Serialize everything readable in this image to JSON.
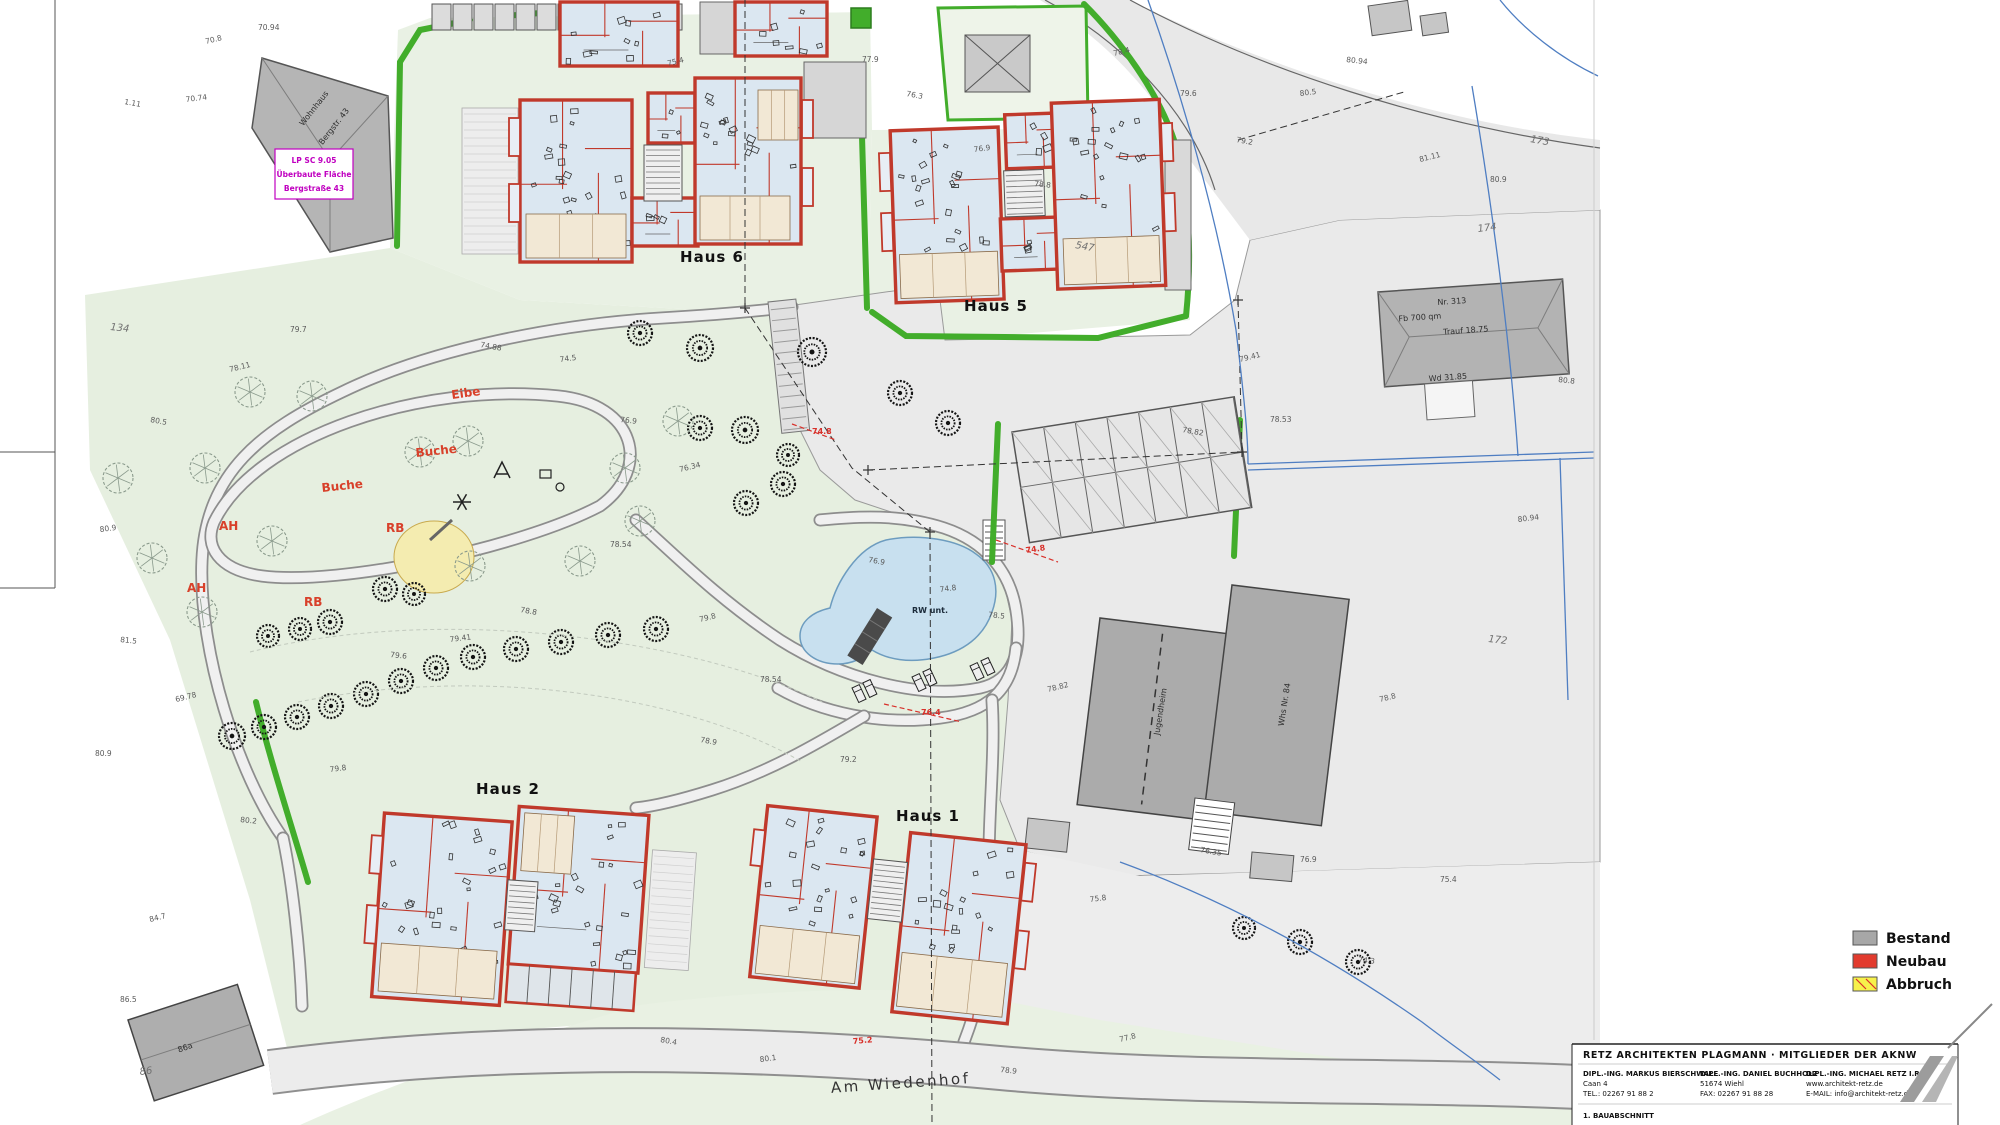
{
  "legend": {
    "items": [
      {
        "label": "Bestand",
        "color": "#a7a7a7"
      },
      {
        "label": "Neubau",
        "color": "#e23b2e"
      },
      {
        "label": "Abbruch",
        "color": "#f6f14b"
      }
    ]
  },
  "labels": {
    "houses": [
      {
        "text": "Haus 6",
        "x": 712,
        "y": 262
      },
      {
        "text": "Haus 5",
        "x": 996,
        "y": 311
      },
      {
        "text": "Haus 2",
        "x": 508,
        "y": 794
      },
      {
        "text": "Haus 1",
        "x": 928,
        "y": 821
      }
    ],
    "street": {
      "text": "Am Wiedenhof",
      "x": 901,
      "y": 1088,
      "rot": -4
    },
    "trees": [
      {
        "text": "Eibe",
        "x": 452,
        "y": 399,
        "rot": -8
      },
      {
        "text": "Buche",
        "x": 416,
        "y": 457,
        "rot": -6
      },
      {
        "text": "Buche",
        "x": 322,
        "y": 492,
        "rot": -6
      },
      {
        "text": "AH",
        "x": 219,
        "y": 530,
        "rot": 0
      },
      {
        "text": "RB",
        "x": 386,
        "y": 532,
        "rot": 0
      },
      {
        "text": "AH",
        "x": 187,
        "y": 592,
        "rot": 0
      },
      {
        "text": "RB",
        "x": 304,
        "y": 606,
        "rot": 0
      }
    ],
    "pond": {
      "text": "RW unt.",
      "x": 912,
      "y": 613
    },
    "bestand": [
      {
        "text": "Nr. 313",
        "x": 1452,
        "y": 304,
        "rot": -4
      },
      {
        "text": "Fb 700 qm",
        "x": 1420,
        "y": 320,
        "rot": -4
      },
      {
        "text": "Trauf 18.75",
        "x": 1466,
        "y": 333,
        "rot": -4
      },
      {
        "text": "Wd 31.85",
        "x": 1448,
        "y": 380,
        "rot": -4
      },
      {
        "text": "Jugendheim",
        "x": 1163,
        "y": 712,
        "rot": -81
      },
      {
        "text": "Whs Nr. 84",
        "x": 1287,
        "y": 705,
        "rot": -81
      },
      {
        "text": "86a",
        "x": 186,
        "y": 1050,
        "rot": -20
      },
      {
        "text": "Wohnhaus",
        "x": 316,
        "y": 110,
        "rot": -52
      },
      {
        "text": "Bergstr. 43",
        "x": 336,
        "y": 128,
        "rot": -52
      }
    ],
    "red_marks": [
      {
        "text": "74.8",
        "x": 1026,
        "y": 553,
        "rot": -8
      },
      {
        "text": "76.4",
        "x": 921,
        "y": 715,
        "rot": 0
      },
      {
        "text": "74.8",
        "x": 812,
        "y": 434,
        "rot": 0
      },
      {
        "text": "75.2",
        "x": 853,
        "y": 1044,
        "rot": -5
      }
    ]
  },
  "note_box": {
    "lines": [
      "LP SC 9.05",
      "Überbaute Fläche",
      "Bergstraße 43"
    ]
  },
  "spot_heights": [
    {
      "v": "70.8",
      "x": 206,
      "y": 44
    },
    {
      "v": "70.94",
      "x": 258,
      "y": 30
    },
    {
      "v": "1.11",
      "x": 124,
      "y": 104
    },
    {
      "v": "70.74",
      "x": 186,
      "y": 102
    },
    {
      "v": "134",
      "x": 110,
      "y": 330,
      "s": 1
    },
    {
      "v": "75.4",
      "x": 668,
      "y": 66
    },
    {
      "v": "77.9",
      "x": 862,
      "y": 62
    },
    {
      "v": "76.3",
      "x": 906,
      "y": 96
    },
    {
      "v": "76.9",
      "x": 974,
      "y": 152
    },
    {
      "v": "78.8",
      "x": 1034,
      "y": 186
    },
    {
      "v": "78.4",
      "x": 1114,
      "y": 56
    },
    {
      "v": "79.6",
      "x": 1180,
      "y": 96
    },
    {
      "v": "79.2",
      "x": 1236,
      "y": 142
    },
    {
      "v": "80.5",
      "x": 1300,
      "y": 96
    },
    {
      "v": "80.94",
      "x": 1346,
      "y": 62
    },
    {
      "v": "81.11",
      "x": 1420,
      "y": 162
    },
    {
      "v": "80.9",
      "x": 1490,
      "y": 182
    },
    {
      "v": "173",
      "x": 1530,
      "y": 142,
      "s": 1
    },
    {
      "v": "174",
      "x": 1478,
      "y": 232,
      "s": 1
    },
    {
      "v": "80.8",
      "x": 1558,
      "y": 382
    },
    {
      "v": "79.41",
      "x": 1240,
      "y": 362
    },
    {
      "v": "78.53",
      "x": 1270,
      "y": 422
    },
    {
      "v": "78.82",
      "x": 1182,
      "y": 432
    },
    {
      "v": "80.94",
      "x": 1518,
      "y": 522
    },
    {
      "v": "172",
      "x": 1488,
      "y": 642,
      "s": 1
    },
    {
      "v": "78.8",
      "x": 1380,
      "y": 702
    },
    {
      "v": "76.9",
      "x": 1300,
      "y": 862
    },
    {
      "v": "76.35",
      "x": 1200,
      "y": 852
    },
    {
      "v": "75.8",
      "x": 1090,
      "y": 902
    },
    {
      "v": "74.3",
      "x": 1358,
      "y": 962
    },
    {
      "v": "78.11",
      "x": 230,
      "y": 372
    },
    {
      "v": "79.7",
      "x": 290,
      "y": 332
    },
    {
      "v": "80.5",
      "x": 150,
      "y": 422
    },
    {
      "v": "80.9",
      "x": 100,
      "y": 532
    },
    {
      "v": "81.5",
      "x": 120,
      "y": 642
    },
    {
      "v": "69.78",
      "x": 176,
      "y": 702
    },
    {
      "v": "80.9",
      "x": 95,
      "y": 756
    },
    {
      "v": "74.88",
      "x": 480,
      "y": 347
    },
    {
      "v": "74.5",
      "x": 560,
      "y": 362
    },
    {
      "v": "76.9",
      "x": 620,
      "y": 422
    },
    {
      "v": "76.34",
      "x": 680,
      "y": 472
    },
    {
      "v": "78.54",
      "x": 610,
      "y": 547
    },
    {
      "v": "78.8",
      "x": 520,
      "y": 612
    },
    {
      "v": "79.41",
      "x": 450,
      "y": 642
    },
    {
      "v": "79.6",
      "x": 390,
      "y": 657
    },
    {
      "v": "79.8",
      "x": 700,
      "y": 622
    },
    {
      "v": "78.54",
      "x": 760,
      "y": 682
    },
    {
      "v": "76.9",
      "x": 868,
      "y": 562
    },
    {
      "v": "74.8",
      "x": 940,
      "y": 592
    },
    {
      "v": "78.5",
      "x": 988,
      "y": 617
    },
    {
      "v": "78.82",
      "x": 1048,
      "y": 692
    },
    {
      "v": "79.2",
      "x": 840,
      "y": 762
    },
    {
      "v": "78.9",
      "x": 700,
      "y": 742
    },
    {
      "v": "79.8",
      "x": 330,
      "y": 772
    },
    {
      "v": "80.2",
      "x": 240,
      "y": 822
    },
    {
      "v": "84.7",
      "x": 150,
      "y": 922
    },
    {
      "v": "86.5",
      "x": 120,
      "y": 1002
    },
    {
      "v": "80.4",
      "x": 660,
      "y": 1042
    },
    {
      "v": "80.1",
      "x": 760,
      "y": 1062
    },
    {
      "v": "78.9",
      "x": 1000,
      "y": 1072
    },
    {
      "v": "77.8",
      "x": 1120,
      "y": 1042
    },
    {
      "v": "75.4",
      "x": 1440,
      "y": 882
    },
    {
      "v": "547",
      "x": 1075,
      "y": 248,
      "s": 1
    },
    {
      "v": "86",
      "x": 140,
      "y": 1075,
      "s": 1
    }
  ],
  "titleblock": {
    "line1": "RETZ ARCHITEKTEN PLAGMANN · MITGLIEDER DER AKNW",
    "col1": [
      "DIPL.-ING. MARKUS BIERSCHWALE",
      "Caan 4",
      "TEL.: 02267 91 88 2"
    ],
    "col2": [
      "DIPL.-ING. DANIEL BUCHHOLZ",
      "51674 Wiehl",
      "FAX: 02267 91 88 28"
    ],
    "col3": [
      "DIPL.-ING. MICHAEL RETZ I.R.",
      "www.architekt-retz.de",
      "E-MAIL: info@architekt-retz.de"
    ],
    "bottom": "1. BAUABSCHNITT"
  }
}
